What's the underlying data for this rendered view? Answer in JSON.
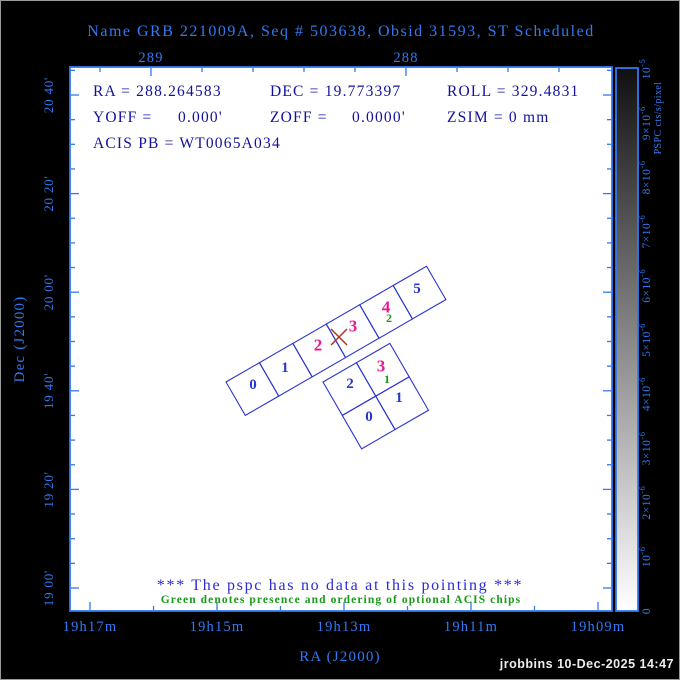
{
  "title": "Name GRB 221009A, Seq # 503638, Obsid 31593, ST Scheduled",
  "info": {
    "ra": "RA = 288.264583",
    "dec": "DEC = 19.773397",
    "roll": "ROLL = 329.4831",
    "yoff_label": "YOFF =",
    "yoff_value": "0.000'",
    "zoff_label": "ZOFF =",
    "zoff_value": "0.0000'",
    "zsim": "ZSIM = 0 mm",
    "acis_pb": "ACIS PB = WT0065A034"
  },
  "axes": {
    "x_title": "RA (J2000)",
    "y_title": "Dec (J2000)",
    "top": {
      "majors": [
        {
          "x": 151,
          "label": "289"
        },
        {
          "x": 406,
          "label": "288"
        }
      ],
      "minors": [
        100,
        202,
        253,
        304,
        355,
        457,
        508,
        559
      ]
    },
    "bottom": {
      "majors": [
        {
          "x": 90,
          "label": "19h17m"
        },
        {
          "x": 217,
          "label": "19h15m"
        },
        {
          "x": 344,
          "label": "19h13m"
        },
        {
          "x": 471,
          "label": "19h11m"
        },
        {
          "x": 598,
          "label": "19h09m"
        }
      ],
      "minors": [
        153.5,
        280.5,
        407.5,
        534.5
      ]
    },
    "left": {
      "majors": [
        {
          "y": 95,
          "label": "20 40'"
        },
        {
          "y": 193.6,
          "label": "20 20'"
        },
        {
          "y": 292.2,
          "label": "20 00'"
        },
        {
          "y": 390.8,
          "label": "19 40'"
        },
        {
          "y": 489.4,
          "label": "19 20'"
        },
        {
          "y": 588,
          "label": "19 00'"
        }
      ],
      "minor_step": 24.65
    }
  },
  "colorbar": {
    "title": "PSPC cts/s/pixel",
    "ticks": [
      {
        "y": 69,
        "base": "10",
        "exp": "-5"
      },
      {
        "y": 123.2,
        "base": "9×10",
        "exp": "-6"
      },
      {
        "y": 177.4,
        "base": "8×10",
        "exp": "-6"
      },
      {
        "y": 231.6,
        "base": "7×10",
        "exp": "-6"
      },
      {
        "y": 285.8,
        "base": "6×10",
        "exp": "-6"
      },
      {
        "y": 340,
        "base": "5×10",
        "exp": "-6"
      },
      {
        "y": 394.2,
        "base": "4×10",
        "exp": "-6"
      },
      {
        "y": 448.4,
        "base": "3×10",
        "exp": "-6"
      },
      {
        "y": 502.6,
        "base": "2×10",
        "exp": "-6"
      },
      {
        "y": 556.8,
        "base": "10",
        "exp": "-6"
      },
      {
        "y": 611,
        "base": "0",
        "exp": ""
      }
    ]
  },
  "acis": {
    "chip_labels": [
      {
        "text": "0",
        "x": 253,
        "y": 385,
        "color": "blue",
        "array": "S"
      },
      {
        "text": "1",
        "x": 285,
        "y": 368,
        "color": "blue",
        "array": "S"
      },
      {
        "text": "2",
        "x": 318,
        "y": 345,
        "color": "magenta",
        "array": "S"
      },
      {
        "text": "3",
        "x": 353,
        "y": 326,
        "color": "magenta",
        "array": "S"
      },
      {
        "text": "4",
        "x": 386,
        "y": 307,
        "color": "magenta",
        "array": "S"
      },
      {
        "text": "2",
        "x": 389,
        "y": 318,
        "color": "green",
        "array": "S"
      },
      {
        "text": "5",
        "x": 417,
        "y": 289,
        "color": "blue",
        "array": "S"
      },
      {
        "text": "2",
        "x": 350,
        "y": 384,
        "color": "blue",
        "array": "I"
      },
      {
        "text": "3",
        "x": 381,
        "y": 366,
        "color": "magenta",
        "array": "I"
      },
      {
        "text": "1",
        "x": 387,
        "y": 379,
        "color": "green",
        "array": "I"
      },
      {
        "text": "0",
        "x": 369,
        "y": 417,
        "color": "blue",
        "array": "I"
      },
      {
        "text": "1",
        "x": 399,
        "y": 398,
        "color": "blue",
        "array": "I"
      }
    ]
  },
  "messages": {
    "pspc": "*** The pspc has no data at this pointing ***",
    "green_note": "Green denotes presence and ordering of optional ACIS chips"
  },
  "footer": "jrobbins 10-Dec-2025 14:47",
  "colors": {
    "accent": "#3279f2",
    "navy": "#12129d",
    "chip_blue": "#2a35cf",
    "magenta": "#e8188f",
    "green": "#189a18",
    "red": "#b23320",
    "msg_blue": "#2b2bd4",
    "footer": "#ededed",
    "plot_bg": "#ffffff",
    "page_bg": "#000000"
  }
}
